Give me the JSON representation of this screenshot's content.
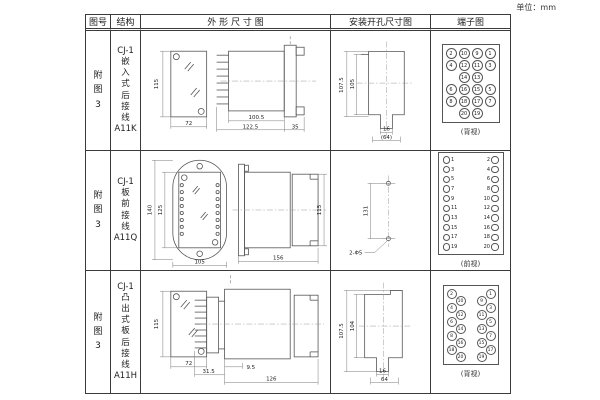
{
  "unit_label": "单位：mm",
  "headers": {
    "fig": "图号",
    "structure": "结构",
    "outline": "外 形 尺 寸 图",
    "mounting": "安装开孔尺寸图",
    "terminal": "端子图"
  },
  "rows": [
    {
      "fig_lines": [
        "附",
        "图",
        "3"
      ],
      "structure_lines": [
        "CJ-1",
        "嵌",
        "入",
        "式",
        "后",
        "接",
        "线",
        "A11K"
      ],
      "outline_dims": {
        "h": "115",
        "w": "72",
        "body": "100.5",
        "total": "122.5",
        "flange": "35"
      },
      "mount_dims": {
        "outer": "107.5",
        "inner": "105",
        "slot": "16",
        "width": "(64)"
      },
      "terminal": {
        "view": "(背视)",
        "grid": [
          [
            "2",
            "10",
            "9",
            "1"
          ],
          [
            "4",
            "12",
            "11",
            "3"
          ],
          [
            "",
            "14",
            "13",
            ""
          ],
          [
            "6",
            "16",
            "15",
            "5"
          ],
          [
            "8",
            "18",
            "17",
            "7"
          ],
          [
            "",
            "20",
            "19",
            ""
          ]
        ]
      }
    },
    {
      "fig_lines": [
        "附",
        "图",
        "3"
      ],
      "structure_lines": [
        "CJ-1",
        "板",
        "前",
        "接",
        "线",
        "A11Q"
      ],
      "outline_dims": {
        "outer_h": "140",
        "inner_h": "125",
        "w": "105",
        "len": "156",
        "side_h": "115"
      },
      "mount_dims": {
        "pitch": "131",
        "holes": "2-Φ5"
      },
      "terminal": {
        "view": "(前视)",
        "left": [
          "1",
          "3",
          "5",
          "7",
          "9",
          "11",
          "13",
          "15",
          "17",
          "19"
        ],
        "right": [
          "2",
          "4",
          "6",
          "8",
          "10",
          "12",
          "14",
          "16",
          "18",
          "20"
        ]
      }
    },
    {
      "fig_lines": [
        "附",
        "图",
        "3"
      ],
      "structure_lines": [
        "CJ-1",
        "凸",
        "出",
        "式",
        "板",
        "后",
        "接",
        "线",
        "A11H"
      ],
      "outline_dims": {
        "h": "115",
        "w": "72",
        "pins": "31.5",
        "step": "9.5",
        "len": "126"
      },
      "mount_dims": {
        "outer": "107.5",
        "inner": "104",
        "slot": "16",
        "width": "64"
      },
      "terminal": {
        "view": "(背视)",
        "left": [
          "2",
          "10",
          "4",
          "12",
          "6",
          "14",
          "8",
          "16",
          "18",
          "20"
        ],
        "right": [
          "1",
          "9",
          "3",
          "11",
          "5",
          "13",
          "7",
          "15",
          "17",
          "19"
        ]
      }
    }
  ]
}
